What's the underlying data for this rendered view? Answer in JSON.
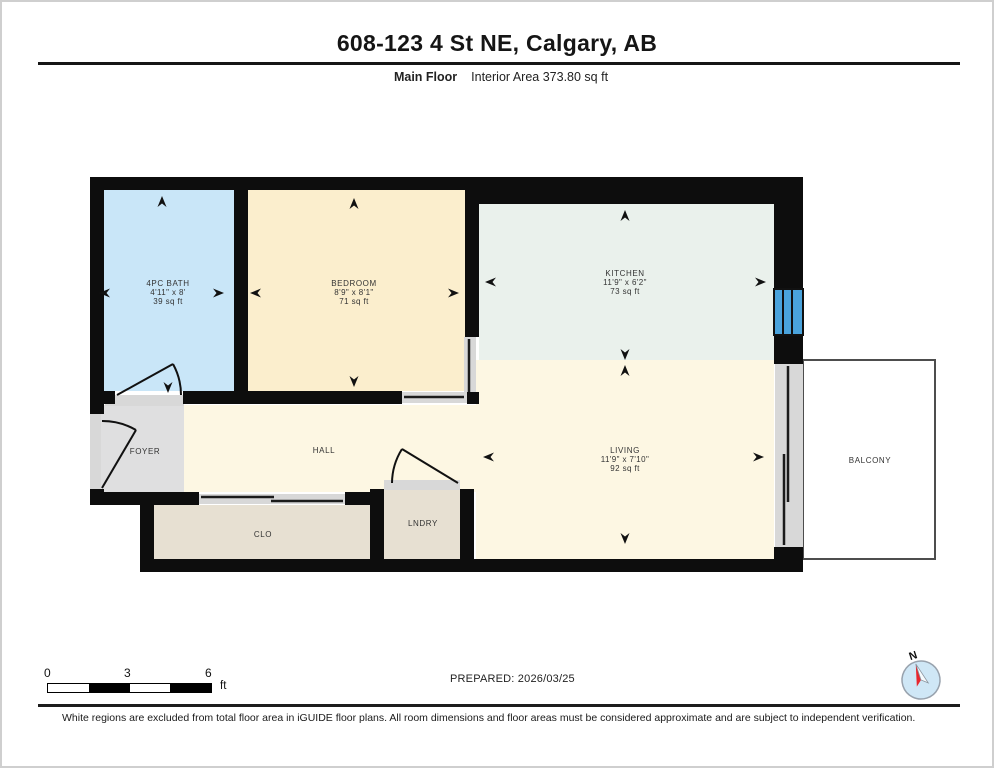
{
  "header": {
    "title": "608-123 4 St NE, Calgary, AB",
    "floor_label": "Main Floor",
    "interior_area": "Interior Area 373.80 sq ft"
  },
  "rooms": {
    "bath": {
      "name": "4PC BATH",
      "dims": "4'11\" x 8'",
      "area": "39 sq ft"
    },
    "bedroom": {
      "name": "BEDROOM",
      "dims": "8'9\" x 8'1\"",
      "area": "71 sq ft"
    },
    "kitchen": {
      "name": "KITCHEN",
      "dims": "11'9\" x 6'2\"",
      "area": "73 sq ft"
    },
    "living": {
      "name": "LIVING",
      "dims": "11'9\" x 7'10\"",
      "area": "92 sq ft"
    },
    "hall": {
      "name": "HALL"
    },
    "foyer": {
      "name": "FOYER"
    },
    "closet": {
      "name": "CLO"
    },
    "laundry": {
      "name": "LNDRY"
    },
    "balcony": {
      "name": "BALCONY"
    }
  },
  "scale_bar": {
    "labels": [
      "0",
      "3",
      "6"
    ],
    "unit": "ft"
  },
  "compass": {
    "north_label": "N"
  },
  "footer": {
    "prepared": "PREPARED: 2026/03/25",
    "disclaimer": "White regions are excluded from total floor area in iGUIDE floor plans. All room dimensions and floor areas must be considered approximate and are subject to independent verification."
  },
  "colors": {
    "wall": "#0d0d0d",
    "bath": "#c9e6f8",
    "bedroom": "#fbeecd",
    "kitchen": "#eaf1ec",
    "living": "#fdf7e3",
    "foyer": "#dfdfe0",
    "closet": "#e7e0d2",
    "threshold": "#d8d8d8",
    "window": "#4aa3dc",
    "balcony_border": "#4d4d4d",
    "compass_fill": "#cfe7f6",
    "needle_red": "#e8262d"
  }
}
